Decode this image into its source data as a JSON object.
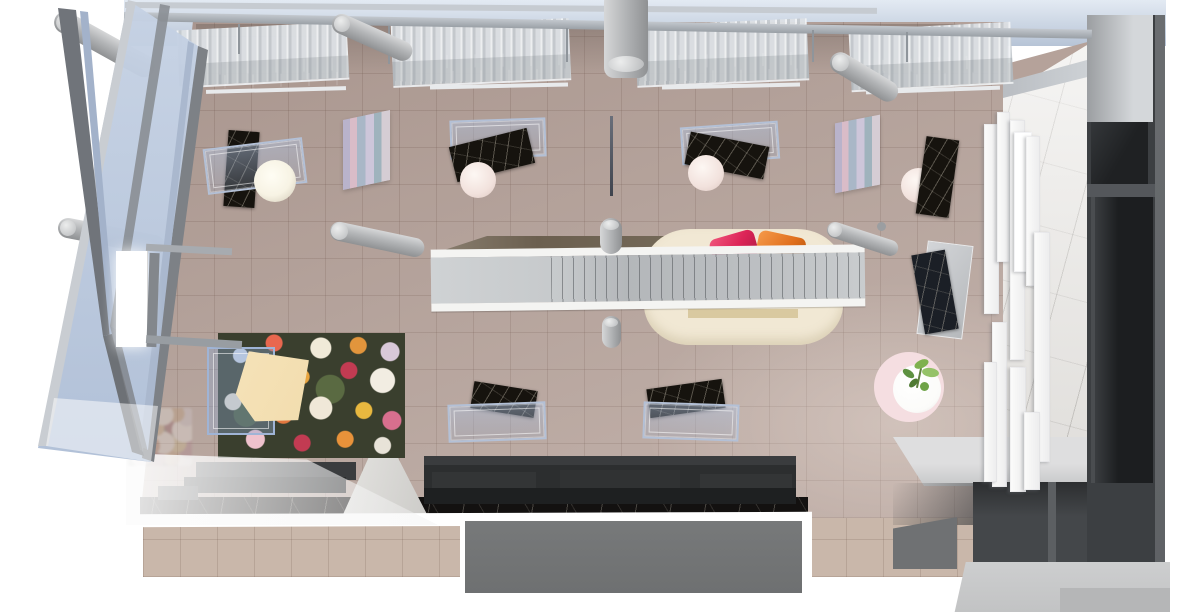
{
  "scene": {
    "kind": "top-down 3d architectural render",
    "space": "retail boutique interior with glazed corner facade",
    "objects": [
      "glass-curtain-wall",
      "steel-roof-beams",
      "corrugated-skylight-panels",
      "track-light-fixtures",
      "concrete-columns",
      "tiled-sales-floor",
      "glass-display-cases",
      "dark-marble-display-tables",
      "round-pedestal-tables",
      "sphere-lamp",
      "gradient-art-panels",
      "hanging-banner-blade",
      "escalator",
      "floor-void",
      "cream-lounge-island",
      "pink-armchair",
      "orange-armchair",
      "floral-rug",
      "rug-display-case",
      "window-bench-seating",
      "black-marble-strip",
      "walkway-gap",
      "entry-vestibule",
      "marble-feature-wall",
      "white-wall-shelving",
      "dark-storage-block",
      "bench-platform",
      "steps",
      "round-pink-rug",
      "plant-side-table",
      "wall-lightbox"
    ]
  },
  "colors": {
    "page-bg": "#ffffff",
    "sky-top": "#e3eaf3",
    "sky-bottom": "#b7c4d6",
    "beam-light": "#c3c8ce",
    "beam-dark": "#9aa0a6",
    "fascia": "#c6cbd1",
    "rod": "#8f959b",
    "roof-panel": "#dde1e5",
    "roof-ridge": "#c6cbd0",
    "fixture-dark": "#131415",
    "fixture-mid": "#2a2c2e",
    "fixture-edge": "#e8eaec",
    "floor": "#b5a29a",
    "sidewalk": "#c9b7aa",
    "facade-glass-top": "#c6d2e4",
    "facade-glass-bottom": "#aebed6",
    "steel-dark": "#70747a",
    "steel-mid": "#8a8e93",
    "steel-light": "#c9cdd2",
    "facade-stripe-blue": "#a3b2ca",
    "cyl-light": "#d6d7d8",
    "cyl-dark": "#8f9193",
    "glasscase-border": "#b3c0d6",
    "marble-dark": "#16130e",
    "marble-blue": "#1b1f26",
    "sphere": "#f7f3e4",
    "roundtable-pink": "#f2e2dd",
    "art-a": "#b9b3cb",
    "art-b": "#d9bcc8",
    "art-c": "#a9b7c7",
    "art-d": "#cdc6da",
    "art-e": "#9fb3bd",
    "blade": "#3f434d",
    "void-tan": "#6b5f4f",
    "tread-light": "#cfd2d4",
    "tread-dark": "#b4b7ba",
    "rail-white": "#f4f4f2",
    "island-cream": "#f1e8d4",
    "island-step-tan": "#d9c9a0",
    "chair-pink": "#dc2457",
    "chair-pink-light": "#f0567c",
    "chair-orange": "#e06f1e",
    "chair-orange-light": "#f59a4a",
    "floral-base": "#3a3f2e",
    "cream-panel": "#f2ddae",
    "rugcase-blue": "#9fb4d6",
    "bench": "#2c2e2f",
    "bench-light": "#3a3c3e",
    "bench-front": "#1e2021",
    "bench-marble": "#131110",
    "walkway": "#e8e7e4",
    "threshold-white": "#ffffff",
    "vestibule-gray": "#6e7071",
    "marble-wall": "#ebe9e6",
    "shelf-white": "#fcfcfb",
    "darkwall": "#3c3f42",
    "darkwall-deep": "#1f2123",
    "darkwall-divider": "#54575b",
    "darkwall-edge": "#5f6265",
    "graywall-light": "#d4d7da",
    "graywall-dark": "#9b9ea1",
    "platform": "#dededf",
    "steps-mid": "#6f7173",
    "band-light": "#cdcecf",
    "band-step": "#b5b6b7",
    "rug-pink": "#f5dee1",
    "table-white": "#fbfbf9",
    "plant-green": "#6fa348",
    "plant-dark": "#4f7a33",
    "lightbox": "#ffffff"
  }
}
